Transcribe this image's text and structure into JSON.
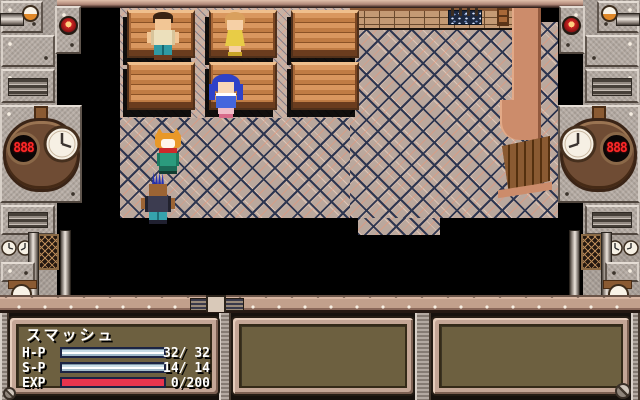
{
  "game": {
    "status_panel": {
      "name": "スマッシュ",
      "rows": [
        {
          "label": "H-P",
          "value": "32/ 32",
          "fill_percent": 100
        },
        {
          "label": "S-P",
          "value": "14/ 14",
          "fill_percent": 100
        },
        {
          "label": "EXP",
          "value": "0/200",
          "fill_percent": 0
        }
      ],
      "bar_empty_color": "#e8344e",
      "bar_fill_color": "#c8dce6",
      "panel_bg_color": "#6d6040"
    },
    "frame": {
      "left_counter": "888",
      "right_counter": "888",
      "metal_color": "#aaa098",
      "trim_color": "#c2a08c"
    },
    "scene": {
      "floor_color": "#c7b2a5",
      "brick_line_color": "#2e3650",
      "wood_color": "#c07c44",
      "counter_color": "#cc8c6b",
      "characters": [
        {
          "id": "npc-man"
        },
        {
          "id": "npc-woman-yellow"
        },
        {
          "id": "npc-girl-blue"
        },
        {
          "id": "npc-fox"
        },
        {
          "id": "npc-punk-mohawk"
        }
      ]
    }
  }
}
